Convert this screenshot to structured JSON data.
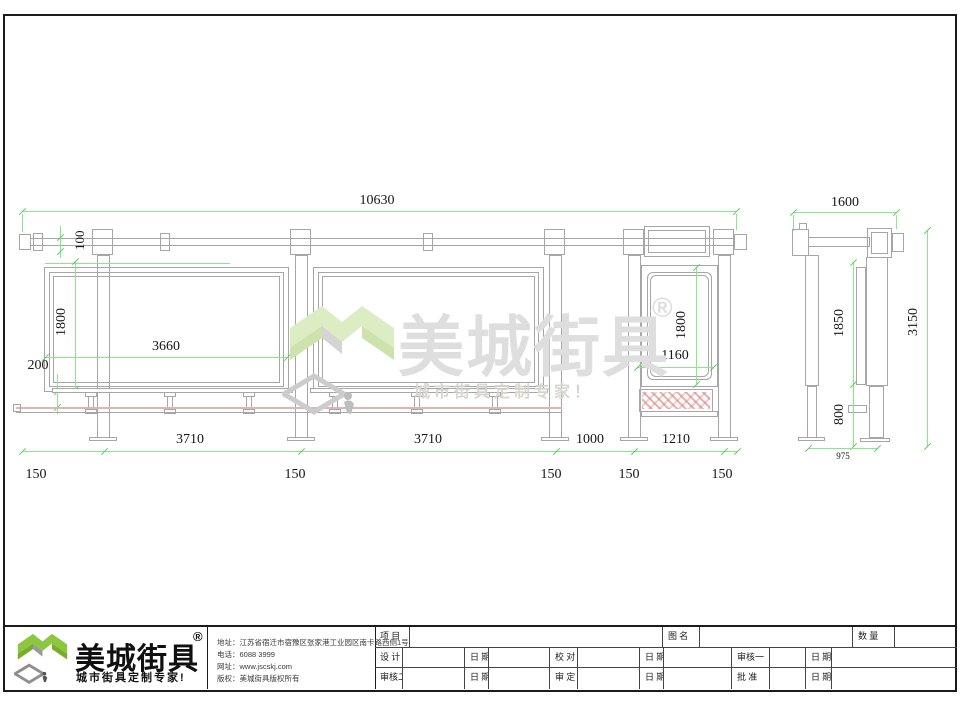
{
  "sheet": {
    "front_view": {
      "dim_total_width": "10630",
      "dim_beam_height": "100",
      "dim_panel_height": "1800",
      "dim_panel_width": "3660",
      "dim_seat_offset": "200",
      "dim_sign_height": "1800",
      "dim_sign_width": "1160",
      "dim_bay1": "3710",
      "dim_bay2": "3710",
      "dim_gap": "1000",
      "dim_sign_base": "1210",
      "dim_post_widths": [
        "150",
        "150",
        "150",
        "150",
        "150"
      ]
    },
    "side_view": {
      "dim_width": "1600",
      "dim_panel_height": "1850",
      "dim_lower_height": "800",
      "dim_total_height": "3150",
      "dim_base_width": "975"
    },
    "watermark": {
      "brand": "美城街具",
      "registered": "®",
      "tagline": "城市街具定制专家！"
    },
    "footer": {
      "logo": {
        "brand": "美城街具",
        "registered": "®",
        "tagline": "城市街具定制专家!"
      },
      "info": [
        {
          "label": "地址：",
          "value": "江苏省宿迁市宿豫区张家港工业园区南卡路西侧1号"
        },
        {
          "label": "电话：",
          "value": "6088 3999"
        },
        {
          "label": "网址：",
          "value": "www.jscskj.com"
        },
        {
          "label": "版权：",
          "value": "美城街具版权所有"
        }
      ],
      "titleblock": {
        "row1": [
          "项 目",
          "",
          "图 名",
          "",
          "数 量",
          ""
        ],
        "row2": [
          "设 计",
          "",
          "日 期",
          "",
          "校 对",
          "",
          "日 期",
          "",
          "审核一",
          "",
          "日 期",
          ""
        ],
        "row3": [
          "审核二",
          "",
          "日 期",
          "",
          "审 定",
          "",
          "日 期",
          "",
          "批 准",
          "",
          "日 期",
          ""
        ]
      }
    },
    "colors": {
      "dimension_green": "#8ae88a",
      "drawing_gray": "#a6a6a6",
      "seat_pink": "#e3b4b4",
      "hatch_pink": "#d37676",
      "brand_green": "#8dc63f",
      "watermark_gray": "#dedede"
    }
  }
}
